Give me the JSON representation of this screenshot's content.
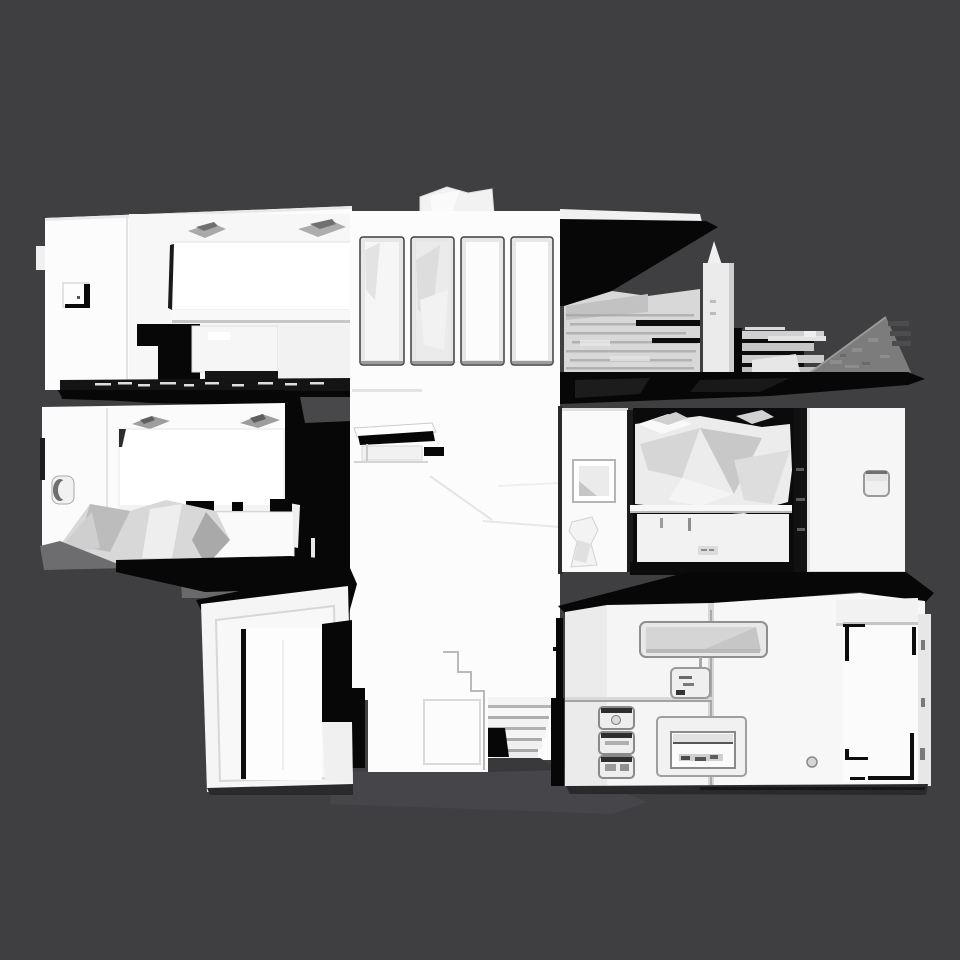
{
  "scene": {
    "type": "3d-mesh-render",
    "subject": "untextured white 3D-scanned building shown as a cut-away side elevation with three stacked floors",
    "background": "dark gray empty viewport, no UI chrome, no text",
    "regions": {
      "upper_left": "bedroom with headboard panel, two wall lamps, wall outlet",
      "upper_center": "facade tower with four tall windows and rooftop box",
      "upper_right": "rooftop terrace with chimney tower, brick parapet, sloped roof wedge, black roof shadow",
      "middle_left": "bedroom with bed, gray drapery, recessed door handle",
      "middle_center": "blank tower wall with small desk shelf",
      "middle_right": "room with framed mirror, pitcher, unmade bed, cabinet, white door with switch plate",
      "lower_left": "entry volume with black roof and open white door",
      "lower_center": "staircase descending between volumes",
      "lower_right": "utility facade with wall niche, stacked appliance boxes, recessed hatch, corner-taped door"
    }
  },
  "colors": {
    "background": "#3f3f41",
    "mesh_white": "#fcfcfc",
    "panel_white": "#f5f5f5",
    "off_white": "#ececec",
    "light_gray": "#d8d8d8",
    "mid_gray": "#aeaeae",
    "wedge_gray": "#7c7c7d",
    "slate_gray": "#58585a",
    "deep_gray": "#48484a",
    "ground_shadow": "#46464a",
    "shadow": "#2a2a2c",
    "black": "#070707"
  }
}
